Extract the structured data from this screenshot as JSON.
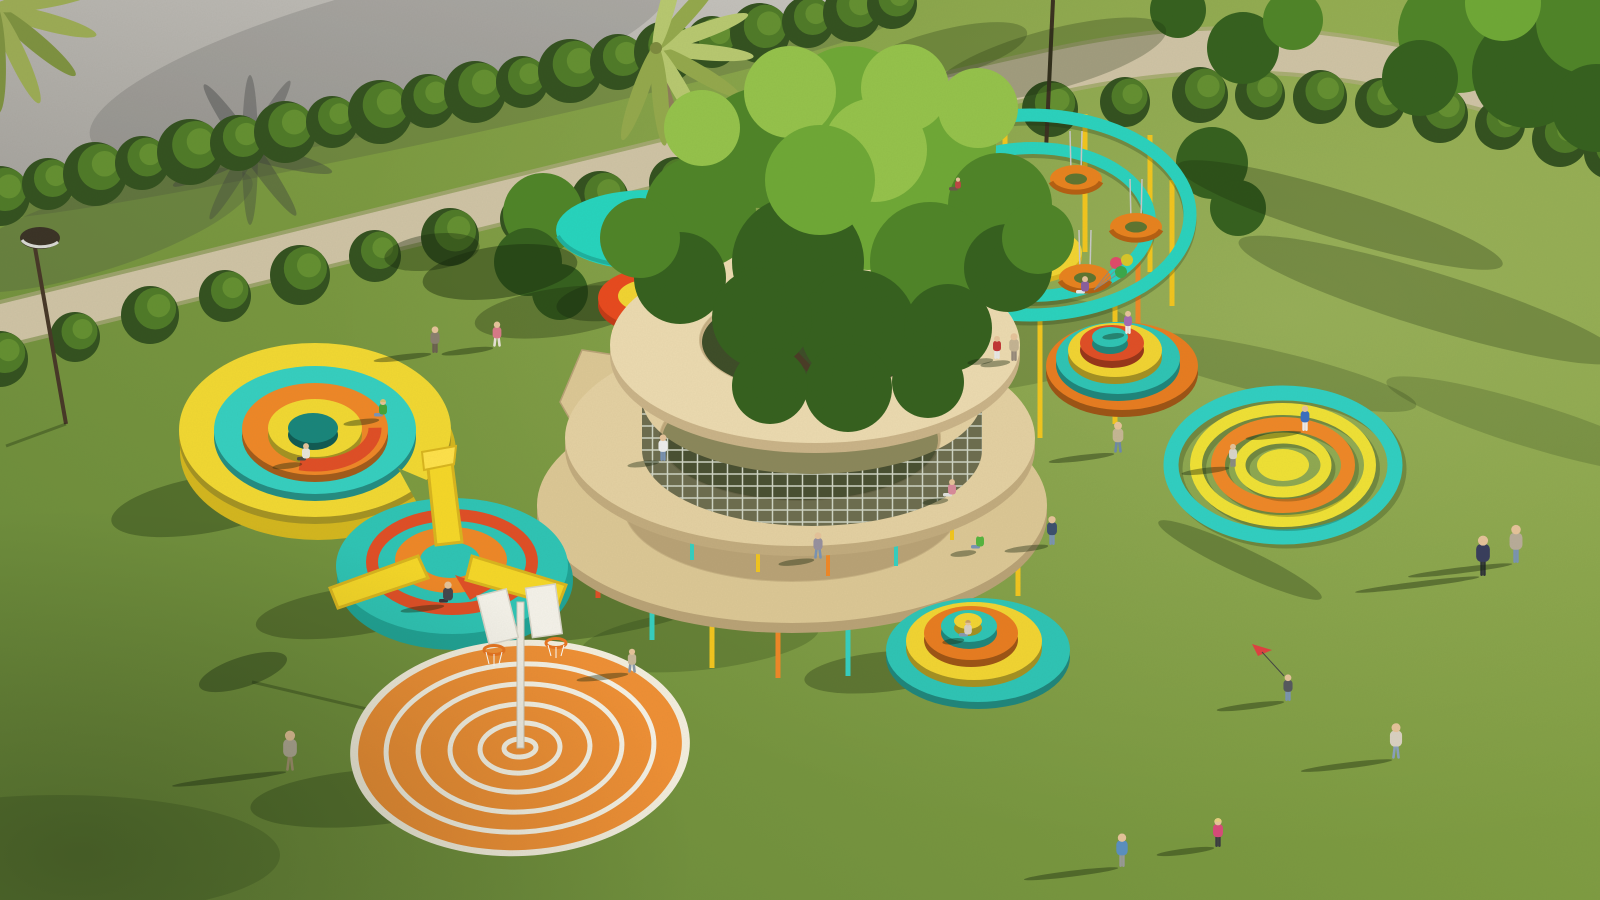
{
  "scene": {
    "description": "Aerial 3D render of a playground park with circular play structures on a lawn",
    "canvas": {
      "w": 1600,
      "h": 900
    },
    "palette": {
      "grass_dark": "#69883a",
      "grass_mid": "#7c9a40",
      "grass_light": "#8fa94b",
      "pavement_dark": "#a5a29d",
      "pavement_light": "#c6c3be",
      "path": "#cfc3a5",
      "teal": "#2ad2be",
      "teal_deep": "#1fa396",
      "yellow": "#f2d432",
      "yellow_deep": "#d9b51e",
      "orange": "#ef8727",
      "red": "#e0471e",
      "wood_light": "#ecdab0",
      "wood_mid": "#e4d0a2",
      "wood_dark": "#dcc795",
      "hedge_dark": "#33511f",
      "hedge_mid": "#4f7a28",
      "hedge_light": "#648f31",
      "trunk": "#8f7d5a",
      "white_struct": "#f2ead8"
    },
    "bushes_upper": [
      [
        0,
        196,
        30
      ],
      [
        48,
        184,
        26
      ],
      [
        95,
        174,
        32
      ],
      [
        142,
        163,
        27
      ],
      [
        190,
        152,
        33
      ],
      [
        238,
        143,
        28
      ],
      [
        285,
        132,
        31
      ],
      [
        332,
        122,
        26
      ],
      [
        380,
        112,
        32
      ],
      [
        428,
        101,
        27
      ],
      [
        475,
        92,
        31
      ],
      [
        522,
        82,
        26
      ],
      [
        570,
        71,
        32
      ],
      [
        618,
        62,
        28
      ],
      [
        665,
        52,
        31
      ],
      [
        712,
        42,
        26
      ],
      [
        760,
        33,
        30
      ],
      [
        808,
        22,
        26
      ],
      [
        852,
        13,
        29
      ],
      [
        892,
        4,
        25
      ]
    ],
    "bushes_lower": [
      [
        0,
        359,
        28
      ],
      [
        75,
        337,
        25
      ],
      [
        150,
        315,
        29
      ],
      [
        225,
        296,
        26
      ],
      [
        300,
        275,
        30
      ],
      [
        375,
        256,
        26
      ],
      [
        450,
        237,
        29
      ],
      [
        525,
        219,
        25
      ],
      [
        600,
        200,
        29
      ],
      [
        675,
        183,
        26
      ],
      [
        750,
        165,
        29
      ],
      [
        825,
        149,
        25
      ],
      [
        900,
        133,
        29
      ],
      [
        975,
        121,
        26
      ],
      [
        1050,
        109,
        28
      ],
      [
        1125,
        102,
        25
      ],
      [
        1200,
        95,
        28
      ],
      [
        1260,
        95,
        25
      ],
      [
        1320,
        97,
        27
      ],
      [
        1380,
        103,
        25
      ],
      [
        1440,
        115,
        28
      ],
      [
        1500,
        125,
        25
      ],
      [
        1560,
        139,
        28
      ],
      [
        1610,
        153,
        26
      ]
    ],
    "canopy_back": [
      [
        543,
        213,
        40,
        1
      ],
      [
        528,
        262,
        34,
        0
      ],
      [
        560,
        292,
        28,
        0
      ],
      [
        1458,
        33,
        60,
        1
      ],
      [
        1528,
        72,
        56,
        0
      ],
      [
        1588,
        22,
        52,
        1
      ],
      [
        1596,
        108,
        44,
        0
      ],
      [
        1420,
        78,
        38,
        0
      ],
      [
        1503,
        3,
        38,
        2
      ],
      [
        1243,
        48,
        36,
        0
      ],
      [
        1293,
        20,
        30,
        1
      ],
      [
        1178,
        10,
        28,
        0
      ],
      [
        1212,
        163,
        36,
        0
      ],
      [
        1238,
        208,
        28,
        0
      ]
    ],
    "canopy_center": [
      [
        850,
        112,
        66,
        2
      ],
      [
        760,
        148,
        60,
        1
      ],
      [
        938,
        148,
        58,
        2
      ],
      [
        700,
        212,
        56,
        1
      ],
      [
        1000,
        205,
        52,
        1
      ],
      [
        868,
        198,
        72,
        2
      ],
      [
        798,
        262,
        66,
        0
      ],
      [
        930,
        262,
        60,
        1
      ],
      [
        680,
        278,
        46,
        0
      ],
      [
        1008,
        268,
        44,
        0
      ],
      [
        858,
        328,
        58,
        0
      ],
      [
        762,
        318,
        50,
        0
      ],
      [
        948,
        328,
        44,
        0
      ],
      [
        640,
        238,
        40,
        1
      ],
      [
        1038,
        238,
        36,
        1
      ],
      [
        905,
        88,
        44,
        3
      ],
      [
        790,
        92,
        46,
        3
      ],
      [
        702,
        128,
        38,
        3
      ],
      [
        978,
        108,
        40,
        3
      ],
      [
        848,
        388,
        44,
        0
      ],
      [
        770,
        386,
        38,
        0
      ],
      [
        928,
        382,
        36,
        0
      ],
      [
        875,
        150,
        52,
        3
      ],
      [
        820,
        180,
        55,
        2
      ]
    ],
    "canopy_tones": [
      "#35601e",
      "#4f8428",
      "#6fa836",
      "#95c24b"
    ],
    "pavement_shadows": [
      [
        250,
        150,
        85,
        10,
        15,
        0.4
      ],
      [
        250,
        150,
        80,
        9,
        55,
        0.4
      ],
      [
        250,
        150,
        85,
        9,
        -25,
        0.4
      ],
      [
        250,
        150,
        75,
        8,
        90,
        0.35
      ],
      [
        250,
        150,
        80,
        8,
        -60,
        0.35
      ],
      [
        380,
        60,
        300,
        70,
        -15,
        0.18
      ],
      [
        100,
        230,
        160,
        40,
        -18,
        0.22
      ],
      [
        430,
        120,
        470,
        22,
        -12,
        0.2
      ]
    ],
    "lawn_shadows": [
      [
        500,
        272,
        78,
        26,
        -8,
        0.42
      ],
      [
        612,
        300,
        56,
        20,
        -8,
        0.36
      ],
      [
        432,
        252,
        48,
        18,
        -8,
        0.36
      ],
      [
        585,
        598,
        160,
        40,
        -8,
        0.28
      ],
      [
        700,
        640,
        120,
        30,
        -6,
        0.2
      ],
      [
        985,
        345,
        150,
        46,
        -6,
        0.18
      ],
      [
        205,
        505,
        95,
        28,
        -10,
        0.33
      ],
      [
        350,
        612,
        95,
        24,
        -8,
        0.3
      ],
      [
        365,
        798,
        115,
        28,
        -5,
        0.28
      ],
      [
        882,
        672,
        78,
        20,
        -6,
        0.3
      ],
      [
        560,
        312,
        86,
        24,
        -8,
        0.3
      ],
      [
        1340,
        215,
        170,
        24,
        17,
        0.27
      ],
      [
        1430,
        300,
        200,
        28,
        17,
        0.25
      ],
      [
        1270,
        372,
        150,
        22,
        13,
        0.2
      ],
      [
        1530,
        425,
        150,
        22,
        17,
        0.18
      ],
      [
        1240,
        560,
        90,
        13,
        25,
        0.28
      ],
      [
        60,
        855,
        220,
        60,
        0,
        0.18
      ],
      [
        1050,
        60,
        120,
        30,
        -15,
        0.25
      ],
      [
        940,
        55,
        90,
        24,
        -15,
        0.25
      ],
      [
        243,
        672,
        46,
        15,
        -18,
        0.38
      ]
    ],
    "shadow_lines": [
      [
        252,
        682,
        516,
        744
      ],
      [
        66,
        424,
        6,
        446
      ]
    ],
    "spiral": {
      "rings": [
        {
          "cx": 792,
          "cy": 505,
          "rx": 255,
          "ry": 118,
          "hx": 792,
          "hy": 505,
          "hrx": 168,
          "hry": 76,
          "f": "#dcc795",
          "s": "#b9a276"
        },
        {
          "cx": 800,
          "cy": 438,
          "rx": 235,
          "ry": 108,
          "hx": 800,
          "hy": 438,
          "hrx": 140,
          "hry": 62,
          "f": "#e4d0a2",
          "s": "#c2ab7e"
        },
        {
          "cx": 815,
          "cy": 345,
          "rx": 205,
          "ry": 98,
          "hx": 812,
          "hy": 340,
          "hrx": 112,
          "hry": 52,
          "f": "#ecdab0",
          "s": "#cab388"
        }
      ],
      "posts_ground": [
        [
          598,
          540,
          598,
          "#e04e26"
        ],
        [
          652,
          568,
          640,
          "#35cfc0"
        ],
        [
          712,
          592,
          668,
          "#f2c51e"
        ],
        [
          778,
          604,
          678,
          "#ef8727"
        ],
        [
          848,
          606,
          676,
          "#35cfc0"
        ],
        [
          912,
          592,
          662,
          "#f2c51e"
        ],
        [
          972,
          566,
          630,
          "#e04e26"
        ],
        [
          1018,
          538,
          596,
          "#f2c51e"
        ]
      ],
      "posts_inner": [
        [
          692,
          518,
          560,
          "#35cfc0"
        ],
        [
          758,
          530,
          572,
          "#f2c51e"
        ],
        [
          828,
          534,
          576,
          "#ef8727"
        ],
        [
          896,
          526,
          566,
          "#35cfc0"
        ],
        [
          952,
          502,
          540,
          "#f2c51e"
        ],
        [
          648,
          292,
          330,
          "#f2c51e"
        ],
        [
          700,
          270,
          305,
          "#35cfc0"
        ],
        [
          935,
          272,
          308,
          "#ef8727"
        ],
        [
          978,
          298,
          332,
          "#f2c51e"
        ],
        [
          614,
          330,
          362,
          "#ef8727"
        ]
      ]
    },
    "carousel": {
      "outer": {
        "cx": 1030,
        "cy": 215,
        "rx": 160,
        "ry": 100,
        "w": 13
      },
      "inner": {
        "cx": 1033,
        "cy": 222,
        "rx": 117,
        "ry": 74,
        "w": 12
      },
      "posts": [
        [
          935,
          132,
          262,
          "#f2c51e"
        ],
        [
          1005,
          112,
          250,
          "#f2c51e"
        ],
        [
          1085,
          114,
          252,
          "#f2c51e"
        ],
        [
          1150,
          135,
          272,
          "#f2c51e"
        ],
        [
          888,
          175,
          302,
          "#f2c51e"
        ],
        [
          1172,
          180,
          306,
          "#f2c51e"
        ],
        [
          952,
          298,
          420,
          "#f2c51e"
        ],
        [
          1040,
          315,
          438,
          "#f2c51e"
        ],
        [
          1115,
          300,
          424,
          "#f2c51e"
        ],
        [
          918,
          240,
          360,
          "#ef8727"
        ],
        [
          1138,
          245,
          362,
          "#ef8727"
        ]
      ],
      "tires": [
        [
          975,
          180
        ],
        [
          1076,
          179
        ],
        [
          920,
          226
        ],
        [
          1136,
          227
        ],
        [
          980,
          270
        ],
        [
          1085,
          278
        ]
      ],
      "mat": {
        "cx": 1028,
        "cy": 252,
        "rx": 54,
        "ry": 27
      }
    },
    "mound_ne": [
      [
        1122,
        366,
        76,
        44,
        "#e87c20"
      ],
      [
        1118,
        358,
        62,
        36,
        "#2ec4b5"
      ],
      [
        1115,
        350,
        47,
        27,
        "#f2d432"
      ],
      [
        1112,
        343,
        32,
        18,
        "#e04e26"
      ],
      [
        1110,
        337,
        18,
        10,
        "#2ec4b5"
      ]
    ],
    "mound_s": [
      [
        978,
        650,
        92,
        52,
        "#2ec4b5"
      ],
      [
        974,
        641,
        68,
        39,
        "#f2d432"
      ],
      [
        971,
        633,
        47,
        27,
        "#e87c20"
      ],
      [
        969,
        626,
        28,
        16,
        "#2ec4b5"
      ],
      [
        968,
        621,
        14,
        8,
        "#f2d432"
      ]
    ],
    "mound_w": [
      [
        315,
        430,
        136,
        87,
        "#f2d832"
      ],
      [
        315,
        430,
        101,
        64,
        "#35cfc0"
      ],
      [
        315,
        429,
        73,
        46,
        "#ef8727"
      ],
      [
        315,
        428,
        47,
        29,
        "#f2d832"
      ],
      [
        313,
        428,
        25,
        15,
        "#18857b"
      ]
    ],
    "target_e": {
      "cx": 1283,
      "cy": 465,
      "rings": [
        [
          112,
          72,
          15,
          "#30cfc2"
        ],
        [
          87,
          56,
          12,
          "#f0e135"
        ],
        [
          65,
          41,
          14,
          "#ef8727"
        ],
        [
          43,
          27,
          11,
          "#f0e135"
        ]
      ],
      "center": [
        26,
        16,
        "#f0e135"
      ]
    },
    "court": {
      "cx": 520,
      "cy": 748,
      "rings": [
        [
          134,
          84
        ],
        [
          102,
          64
        ],
        [
          70,
          44
        ],
        [
          40,
          25
        ],
        [
          16,
          9
        ]
      ]
    },
    "palm": {
      "cx": 656,
      "cy": 48,
      "fronds": [
        5,
        30,
        60,
        85,
        -20,
        -48,
        -75,
        110
      ],
      "corner_fronds": [
        15,
        40,
        65,
        88,
        -10
      ]
    },
    "people": [
      [
        435,
        352,
        24,
        "#8a7f6e",
        "#6b5f50",
        "s",
        58
      ],
      [
        497,
        346,
        23,
        "#d87a88",
        "#e8e2d6",
        "w",
        52
      ],
      [
        383,
        418,
        21,
        "#46a33a",
        "#7a93b5",
        "t",
        36,
        "#d8c070"
      ],
      [
        306,
        462,
        21,
        "#e8e4da",
        "#4a4a45",
        "t",
        30
      ],
      [
        448,
        604,
        26,
        "#45454e",
        "#35353c",
        "t",
        44
      ],
      [
        632,
        672,
        22,
        "#c9b89a",
        "#8898a8",
        "r",
        52
      ],
      [
        290,
        770,
        36,
        "#b3aa98",
        "#a39270",
        "w",
        115
      ],
      [
        663,
        460,
        24,
        "#ededed",
        "#7a93b5",
        "s",
        32
      ],
      [
        818,
        558,
        24,
        "#97909f",
        "#7a93b5",
        "w",
        36
      ],
      [
        952,
        498,
        21,
        "#d88a9a",
        "#e0e0dc",
        "t",
        26
      ],
      [
        980,
        550,
        21,
        "#56b43e",
        "#7a93b5",
        "t",
        26
      ],
      [
        997,
        358,
        21,
        "#c23535",
        "#e8e8e8",
        "s",
        26
      ],
      [
        1014,
        360,
        25,
        "#c4b393",
        "#96887a",
        "s",
        30
      ],
      [
        1052,
        544,
        26,
        "#3c4f6e",
        "#7a93b5",
        "s",
        44
      ],
      [
        1085,
        295,
        21,
        "#8a5f9e",
        "#e8e8e8",
        "t",
        0
      ],
      [
        958,
        192,
        15,
        "#c04545",
        "#6a5a48",
        "t",
        0
      ],
      [
        1128,
        333,
        21,
        "#a06bb3",
        "#efefef",
        "s",
        22
      ],
      [
        1118,
        452,
        28,
        "#c6b694",
        "#6e88aa",
        "w",
        66
      ],
      [
        1305,
        430,
        23,
        "#3a6fc0",
        "#eeeeee",
        "s",
        56
      ],
      [
        1233,
        466,
        21,
        "#d9d5c9",
        "#8a8a85",
        "s",
        48
      ],
      [
        1483,
        575,
        36,
        "#383d5c",
        "#2e3238",
        "s",
        125
      ],
      [
        1516,
        562,
        34,
        "#b9ac99",
        "#7a93b5",
        "s",
        105
      ],
      [
        1288,
        700,
        24,
        "#55585e",
        "#7a93b5",
        "s",
        68
      ],
      [
        1396,
        758,
        32,
        "#dad1c2",
        "#8aa0bc",
        "w",
        92
      ],
      [
        1218,
        846,
        26,
        "#d84a7a",
        "#3a3a40",
        "s",
        58,
        "#e8d080"
      ],
      [
        1122,
        866,
        30,
        "#5a8fc0",
        "#9a9a98",
        "s",
        95
      ],
      [
        968,
        638,
        20,
        "#d8d0c4",
        "#8a98b0",
        "t",
        22,
        "#c8a060"
      ]
    ],
    "balloons": [
      [
        1116,
        263,
        6,
        "#e04a6a"
      ],
      [
        1127,
        260,
        6,
        "#d8c72a"
      ],
      [
        1121,
        272,
        6,
        "#3aa84a"
      ]
    ],
    "balloon_hand": [
      1094,
      290
    ]
  }
}
